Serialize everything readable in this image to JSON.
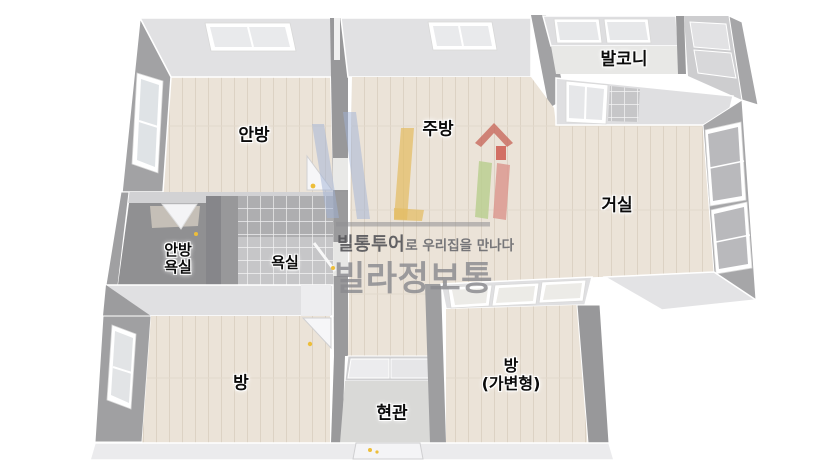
{
  "canvas": {
    "width": 840,
    "height": 472,
    "background": "#ffffff"
  },
  "palette": {
    "floor_wood": "#ebe3d8",
    "floor_tile_bath": "#c6c6c8",
    "floor_entrance": "#d9d9d7",
    "floor_balcony": "#e8e8e6",
    "wall_top_face": "#e1e1e3",
    "wall_side_face": "#a2a2a4",
    "wall_dark_face": "#909092",
    "window_glass": "#e7e8ea",
    "door_handle_yellow": "#edbe3a",
    "logo_blue": "#9fb1d6",
    "logo_yellow": "#e3bd62",
    "logo_red": "#c96a5e",
    "logo_green": "#b9cf8e",
    "logo_pink": "#dc958c"
  },
  "rooms": [
    {
      "key": "master-bedroom",
      "label": "안방"
    },
    {
      "key": "kitchen",
      "label": "주방"
    },
    {
      "key": "balcony",
      "label": "발코니"
    },
    {
      "key": "living-room",
      "label": "거실"
    },
    {
      "key": "master-bathroom",
      "line1": "안방",
      "line2": "욕실"
    },
    {
      "key": "bathroom",
      "label": "욕실"
    },
    {
      "key": "room",
      "label": "방"
    },
    {
      "key": "entrance",
      "label": "현관"
    },
    {
      "key": "convertible-room",
      "line1": "방",
      "line2": "(가변형)"
    }
  ],
  "watermark": {
    "house_icon": "house-icon",
    "tagline_bold": "빌통투어",
    "tagline_rest": "로 우리집을 만나다",
    "brand": "빌라정보통"
  }
}
